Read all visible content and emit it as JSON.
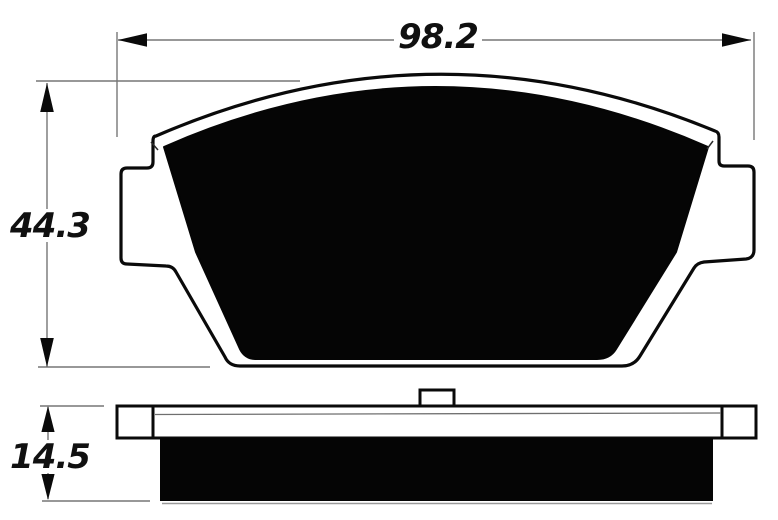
{
  "title": "Brake pad dimensional drawing",
  "dimensions": {
    "width": {
      "value": "98.2"
    },
    "height": {
      "value": "44.3"
    },
    "thickness": {
      "value": "14.5"
    }
  },
  "colors": {
    "pad_fill": "#050505",
    "outline": "#0a0a0a",
    "dim_line": "#767676",
    "label_color": "#101010",
    "background": "#ffffff"
  }
}
